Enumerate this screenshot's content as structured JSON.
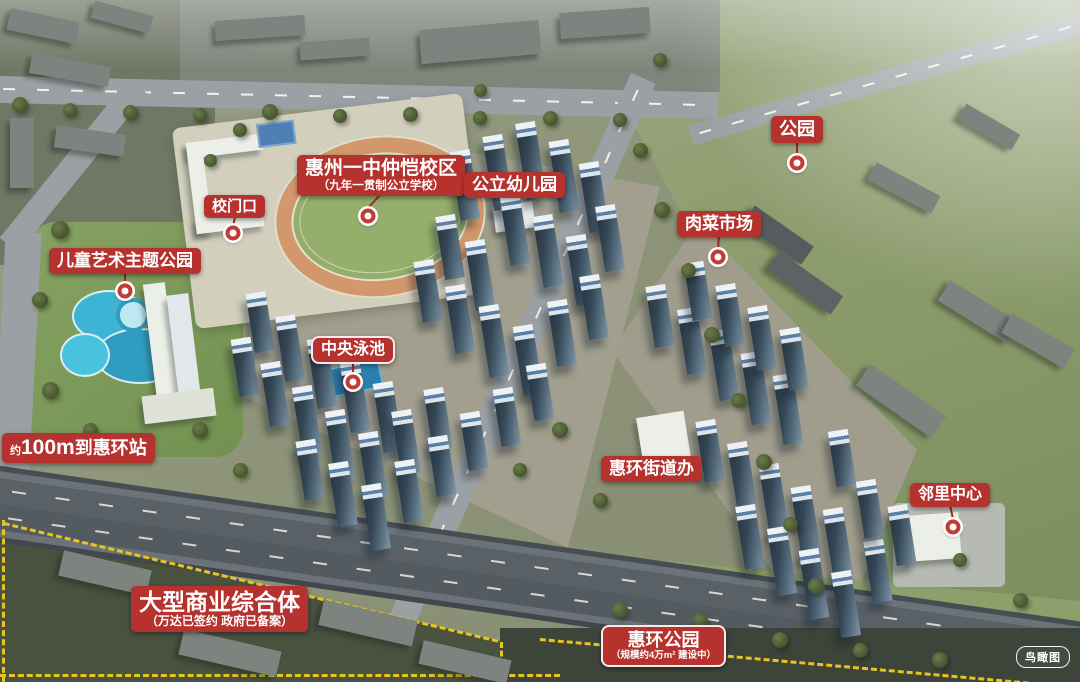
{
  "scene": {
    "type": "aerial-masterplan-rendering",
    "watermark": "鸟瞰图"
  },
  "colors": {
    "label_red": "#b5322e",
    "marker_red": "#c23b34",
    "boundary_yellow": "#e8c41d"
  },
  "annotations": [
    {
      "id": "school",
      "label": "惠州一中仲恺校区",
      "sublabel": "（九年一贯制公立学校）",
      "variant": "plain",
      "fs": 19,
      "sfs": 11.5,
      "x": 297,
      "y": 155,
      "marker": {
        "x": 368,
        "y": 216
      }
    },
    {
      "id": "kindergarten",
      "label": "公立幼儿园",
      "variant": "plain",
      "fs": 17,
      "x": 464,
      "y": 172
    },
    {
      "id": "school-gate",
      "label": "校门口",
      "variant": "plain",
      "fs": 15,
      "x": 204,
      "y": 195,
      "marker": {
        "x": 233,
        "y": 233
      }
    },
    {
      "id": "children-art-park",
      "label": "儿童艺术主题公园",
      "variant": "plain",
      "fs": 17,
      "x": 49,
      "y": 248,
      "marker": {
        "x": 125,
        "y": 291
      }
    },
    {
      "id": "central-pool",
      "label": "中央泳池",
      "variant": "bordered",
      "fs": 16,
      "x": 311,
      "y": 336,
      "marker": {
        "x": 353,
        "y": 382
      }
    },
    {
      "id": "park",
      "label": "公园",
      "variant": "plain",
      "fs": 18,
      "x": 771,
      "y": 116,
      "marker": {
        "x": 797,
        "y": 163
      }
    },
    {
      "id": "market",
      "label": "肉菜市场",
      "variant": "plain",
      "fs": 17,
      "x": 677,
      "y": 211,
      "marker": {
        "x": 718,
        "y": 257
      }
    },
    {
      "id": "street-office",
      "label": "惠环街道办",
      "variant": "plain",
      "fs": 17,
      "x": 601,
      "y": 456
    },
    {
      "id": "neighborhood-center",
      "label": "邻里中心",
      "variant": "plain",
      "fs": 16,
      "x": 910,
      "y": 483,
      "marker": {
        "x": 953,
        "y": 527
      }
    },
    {
      "id": "metro",
      "parts": {
        "prefix": "约",
        "strong": "100m",
        "suffix": "到惠环站"
      },
      "variant": "plain",
      "fs": 18,
      "x": 2,
      "y": 433
    },
    {
      "id": "commercial-complex",
      "label": "大型商业综合体",
      "sublabel": "（万达已签约  政府已备案）",
      "variant": "plain",
      "fs": 23,
      "sfs": 12,
      "x": 131,
      "y": 586
    },
    {
      "id": "huihuan-park",
      "label": "惠环公园",
      "sublabel": "（规模约4万m²  建设中）",
      "variant": "bordered",
      "fs": 18,
      "sfs": 9.5,
      "x": 601,
      "y": 625
    }
  ]
}
